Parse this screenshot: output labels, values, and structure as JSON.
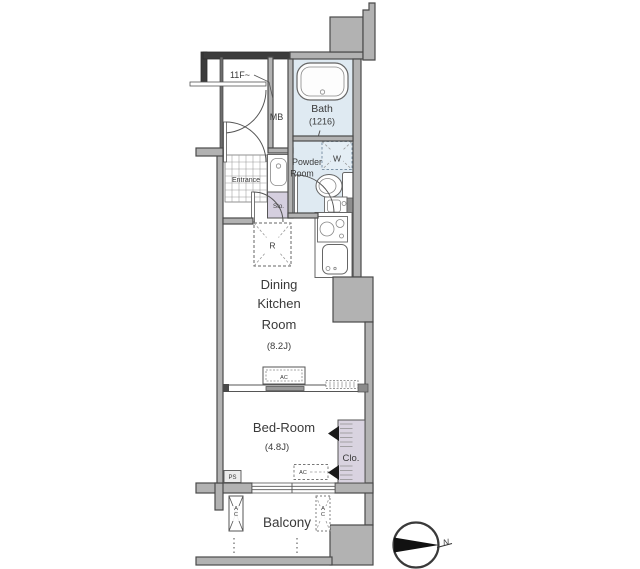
{
  "floorplan": {
    "floor_note": "11F~",
    "rooms": {
      "bath": {
        "name": "Bath",
        "size": "(1216)"
      },
      "powder": {
        "name_line1": "Powder",
        "name_line2": "Room"
      },
      "entrance": {
        "name": "Entrance"
      },
      "dining_kitchen": {
        "name_line1": "Dining",
        "name_line2": "Kitchen",
        "name_line3": "Room",
        "size": "(8.2J)"
      },
      "bedroom": {
        "name": "Bed-Room",
        "size": "(4.8J)"
      },
      "balcony": {
        "name": "Balcony"
      },
      "closet": {
        "name": "Clo."
      }
    },
    "fixtures": {
      "meter_box": "MB",
      "storage": "Sto.",
      "refrigerator": "R",
      "washer": "W",
      "pipe_shaft": "PS",
      "air_conditioner": "AC"
    },
    "compass": {
      "north": "N"
    },
    "colors": {
      "wall_fill": "#b2b2b2",
      "wall_dark": "#3c3c3c",
      "wall_stroke": "#4a4a4a",
      "wet_area": "#dfeaf2",
      "closet_fill": "#d9d3e0",
      "line": "#555555"
    }
  }
}
